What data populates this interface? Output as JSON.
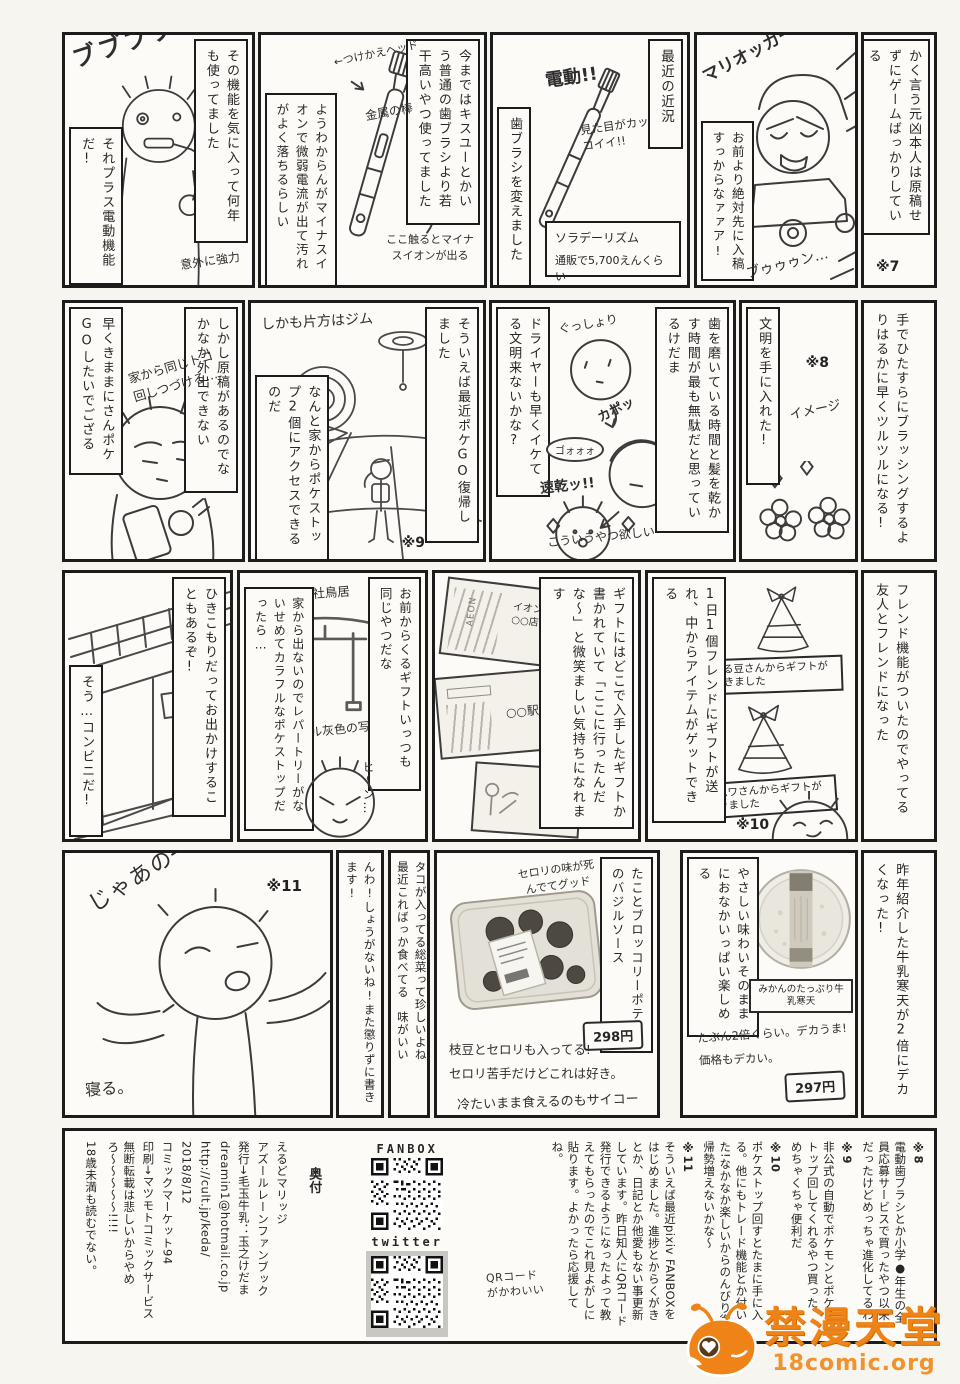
{
  "r1": {
    "aside": {
      "text": "かく言う元凶本人は原稿せずにゲームばっかりしている",
      "ref": "※7"
    },
    "kart": {
      "shout": "マリオッカートエェェイッ!!",
      "speech": "お前より絶対先に入稿すっからなァァア!",
      "sfx": "ブゥゥゥン…"
    },
    "kinkyo": {
      "title": "最近の近況",
      "fx1": "電動!!",
      "fx2": "見た目がカッコイイ!!",
      "caption": "歯ブラシを変えました",
      "product": "ソラデーリズム",
      "price": "通販で5,700えんくらい"
    },
    "brush": {
      "caption": "今まではキスユーとかいう普通の歯ブラシより若干高いやつ使ってました",
      "side": "ようわからんがマイナスイオンで微弱電流が出て汚れがよく落ちるらしい",
      "head": "←つけかえヘッド",
      "rod": "金属の棒",
      "touch": "ここ触るとマイナスイオンが出る"
    },
    "brushing": {
      "caption": "その機能を気に入って何年も使ってました",
      "caption2": "それプラス電動機能だ!",
      "sfx": "ブブブブブ",
      "note": "意外に強力"
    }
  },
  "r2": {
    "aside": {
      "text": "手でひたすらにブラッシングするよりはるかに早くツルツルになる!"
    },
    "bunmei": {
      "caption": "文明を手に入れた!",
      "ref": "※8",
      "note": "イメージ"
    },
    "dryer": {
      "caption": "歯を磨いている時間と髪を乾かす時間が最も無駄だと思っているけだま",
      "caption2": "ドライヤーも早くイケてる文明来ないかな?",
      "fx1": "ぐっしょり",
      "fx2": "カポッ",
      "fx3": "ゴォォォ",
      "fx4": "速乾ッ!!",
      "fx5": "こういうやつ欲しい"
    },
    "gym": {
      "label": "しかも片方はジム",
      "caption": "そういえば最近ポケGO復帰しました",
      "caption2": "なんと家からポケストップ2個にアクセスできるのだ",
      "ref": "※9"
    },
    "phone": {
      "caption": "しかし原稿があるのでなかなか外出できない",
      "caption2": "早くきままにさんポケGOしたいでござる",
      "fx": "家から同じトコ回しつづける…"
    }
  },
  "r3": {
    "aside": {
      "text": "フレンド機能がついたのでやってる友人とフレンドになった"
    },
    "gifts": {
      "caption": "1日1個フレンドにギフトが送れ、中からアイテムがゲットできる",
      "gift1": "える豆さんからギフトが届きました",
      "gift2": "ワムワさんからギフトが届きました",
      "ref": "※10"
    },
    "photos": {
      "caption": "ギフトにはどこで入手したギフトか書かれていて「ここに行ったんだな〜」と微笑ましい気持ちになれます",
      "card1_logo": "AEON",
      "card1": "イオン○○店",
      "card2": "○○駅",
      "card3": "○○公園"
    },
    "torii": {
      "caption": "お前からくるギフトいっつも同じやつだな",
      "label": "○○神社鳥居",
      "note": "オール灰色の写真",
      "caption2": "家から出ないのでレパートリーがないせめてカラフルなポケストップだったら…",
      "fx": "ヒ〜ン…"
    },
    "konbini": {
      "caption": "ひきこもりだってお出かけすることもあるぞ!",
      "caption2": "そう…コンビニだ!"
    }
  },
  "r4": {
    "aside": {
      "text": "昨年紹介した牛乳寒天が2倍にデカくなった!"
    },
    "kanten": {
      "side": "やさしい味わいそのままにおなかいっぱい楽しめる",
      "label": "みかんのたっぷり牛乳寒天",
      "note1": "たぶん2倍くらい。デカうま!",
      "note2": "価格もデカい。",
      "price": "297円"
    },
    "basil": {
      "caption": "たことブロッコリーポテトのバジルソース",
      "fx": "セロリの味が死んでてグッド",
      "price": "298円",
      "note1": "枝豆とセロリも入ってる!",
      "note2": "セロリ苦手だけどこれは好き。",
      "note3": "冷たいまま食えるのもサイコー"
    },
    "tako": {
      "line1": "タコが入ってる総菜って珍しいよね",
      "line2": "最近こればっか食べてる　味がいい"
    },
    "more": {
      "text": "もっといろいろ紹介したいけどページ足りんわ!しょうがないね!また懲りずに書きます!"
    },
    "bye": {
      "fx1": "じゃあの─",
      "ref": "※11",
      "fx2": "寝る。"
    }
  },
  "colophon": {
    "n7": {
      "ref": "※7",
      "text": "1位になったら原稿戻るって言ってウソばっかりつくんですよ(告発)"
    },
    "n8": {
      "ref": "※8",
      "text": "電動歯ブラシとか小学●年生の全員応募サービスで買ったやつ以来だったけどめっちゃ進化してるわ"
    },
    "n9": {
      "ref": "※9",
      "text": "非公式の自動でポケモンとポケストップ回してくれるやつ買った、めちゃくちゃ便利だ"
    },
    "n10": {
      "ref": "※10",
      "text": "ポケストップ回すとたまに手に入る。他にもトレード機能とか付いた!なかなか楽しいからのんびり復帰勢増えないかな〜"
    },
    "n11": {
      "ref": "※11",
      "text": "そういえば最近pixiv FANBOXをはじめました。進捗とからくがきとか、日記とか他愛もない事更新しています。昨日知人にQRコード発行できるようになったよって教えてもらったのでこれ見よがしに貼ります。よかったら応援してね。"
    },
    "qr1_label": "FANBOX",
    "qr2_label": "twitter",
    "qr_note": "QRコードがかわいい",
    "okuzuke_title": "奥付",
    "lines": [
      "えるどマリッジ",
      "アズールレーンファンブック",
      "発行→毛玉牛乳：玉之けだま",
      "dreamin1@hotmail.co.jp",
      "http://cult.jp/keda/",
      "2018/8/12",
      "コミックマーケット94",
      "印刷→マツモトコミックサービス"
    ],
    "warn1": "無断転載は悲しいからやめろ〜〜〜〜〜!!!!",
    "warn2": "18歳未満も読むでない。"
  },
  "watermark": {
    "name": "禁漫天堂",
    "url": "18comic.org"
  }
}
